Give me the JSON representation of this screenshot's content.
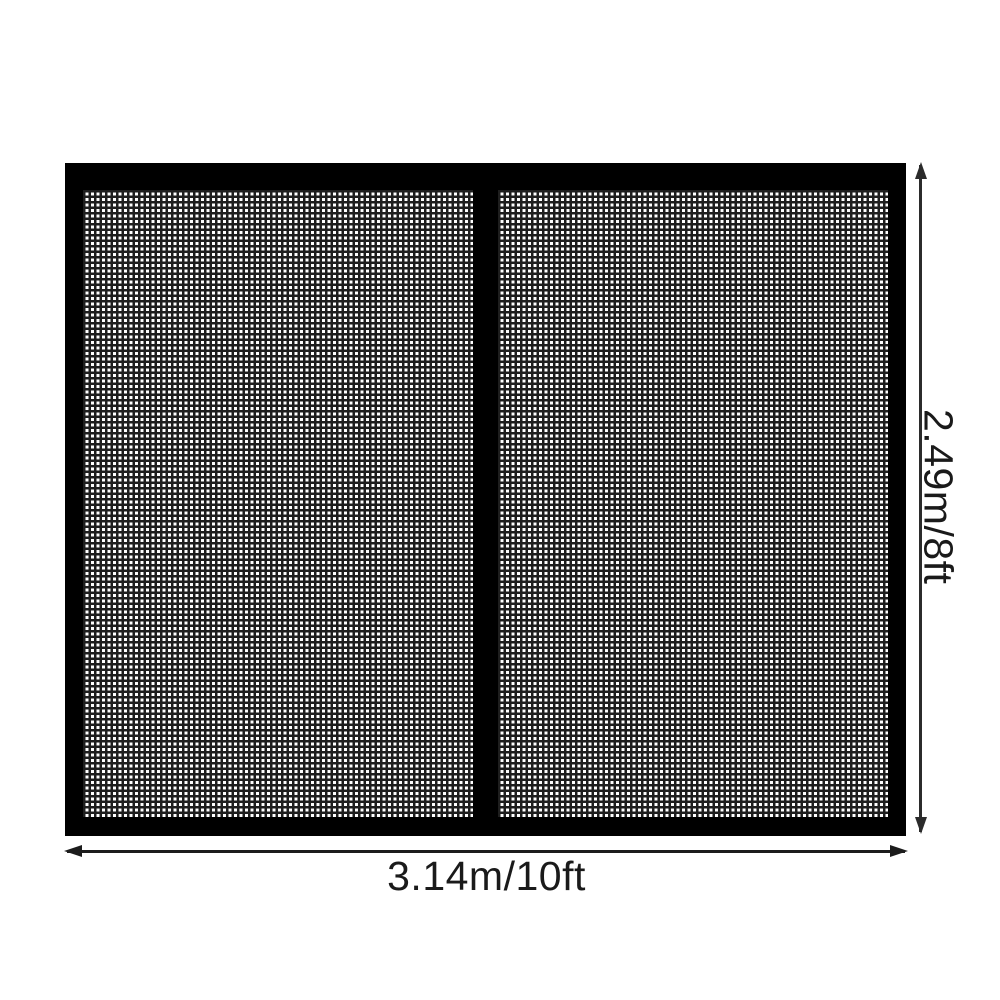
{
  "figure": {
    "width_label": "3.14m/10ft",
    "height_label": "2.49m/8ft"
  },
  "colors": {
    "background": "#ffffff",
    "frame": "#000000",
    "mesh_line": "#1e1e1e",
    "mesh_background": "#ffffff",
    "dimension_line": "#2b2b2b",
    "label_text": "#1a1a1a"
  }
}
